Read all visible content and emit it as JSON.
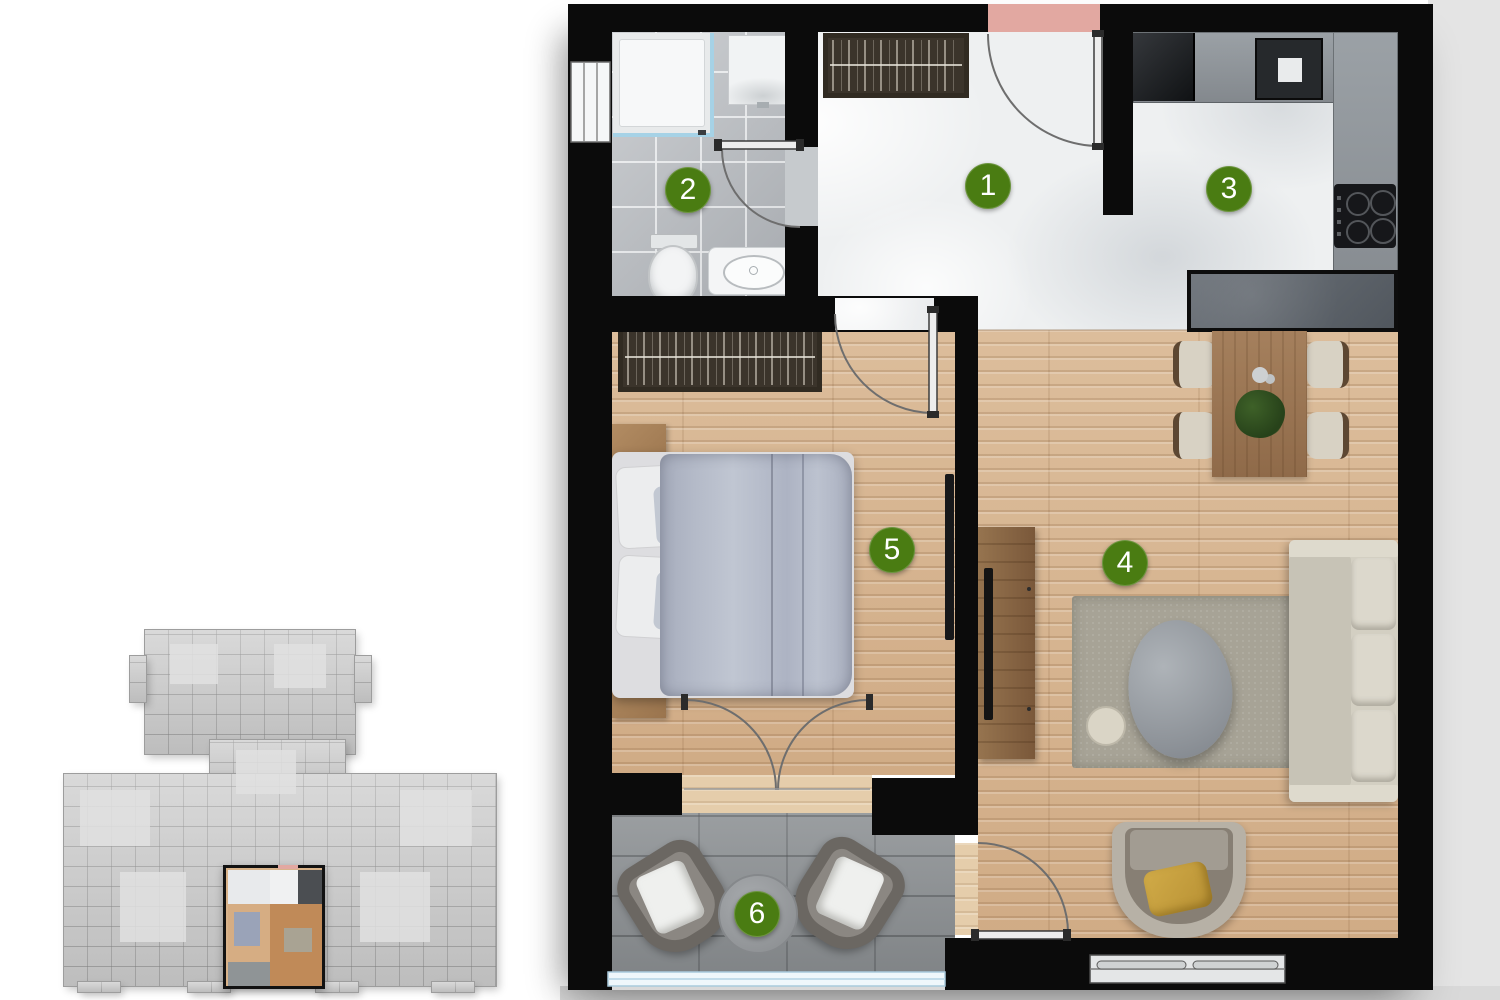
{
  "rooms": [
    {
      "label": "1"
    },
    {
      "label": "2"
    },
    {
      "label": "3"
    },
    {
      "label": "4"
    },
    {
      "label": "5"
    },
    {
      "label": "6"
    }
  ],
  "colors": {
    "marker_green": "#4a7c12",
    "entry_pink": "#e2a8a1",
    "wall_black": "#0b0b0b",
    "wood_floor": "#d6b48f",
    "marble_floor": "#eef0f1",
    "bath_tile": "#b4b8bd",
    "balcony_stone": "#8f9396",
    "rug_green_gray": "#a7a396",
    "counter_gray": "#9aa0a5",
    "counter_dark": "#5e646b",
    "duvet_blue_gray": "#b2b8c6",
    "glass_blue": "#a6d2e6"
  }
}
